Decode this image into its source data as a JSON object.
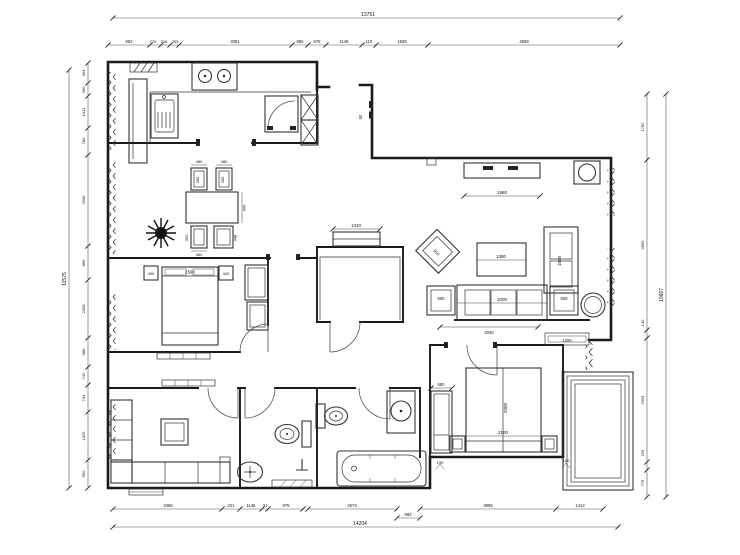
{
  "plan": {
    "colors": {
      "line": "#1a1a1a",
      "background": "#ffffff"
    },
    "dims": {
      "top": {
        "overall": "13751",
        "segments": [
          "952",
          "770",
          "226",
          "253",
          "3381",
          "955",
          "578",
          "1145",
          "110",
          "1838",
          "4569"
        ]
      },
      "bottom": {
        "overall": "14204",
        "segments": [
          "2456",
          "221",
          "1146",
          "31",
          "975",
          "2573",
          "993",
          "3995",
          "1412"
        ]
      },
      "left": {
        "overall": "11575",
        "segments": [
          "354",
          "360",
          "1011",
          "780",
          "2505",
          "866",
          "2358",
          "988",
          "742",
          "743",
          "1425",
          "650"
        ]
      },
      "right": {
        "overall": "10667",
        "segments": [
          "1782",
          "4599",
          "140",
          "3354",
          "255",
          "775"
        ]
      }
    },
    "labels": {
      "entry": "60",
      "tv": "1980",
      "armchair": "910",
      "coffee": "1380",
      "loveseat": "1600",
      "sofa": "2000",
      "side_l": "600",
      "side_r": "600",
      "sofa_wall": "2030",
      "hall_cab": "1200",
      "study_cab": "1310",
      "bed1": "1590",
      "ns_l": "400",
      "ns_r": "400",
      "bed2_len": "2300",
      "bed2_wid": "2100",
      "closet": "580",
      "gap1": "190",
      "gap2": "190",
      "chair_t1": "480",
      "chair_t2": "480",
      "chair_d1": "300",
      "chair_d2": "300",
      "table_d": "900",
      "chair_b1": "350",
      "chair_b1w": "480",
      "chair_b2": "348"
    }
  }
}
